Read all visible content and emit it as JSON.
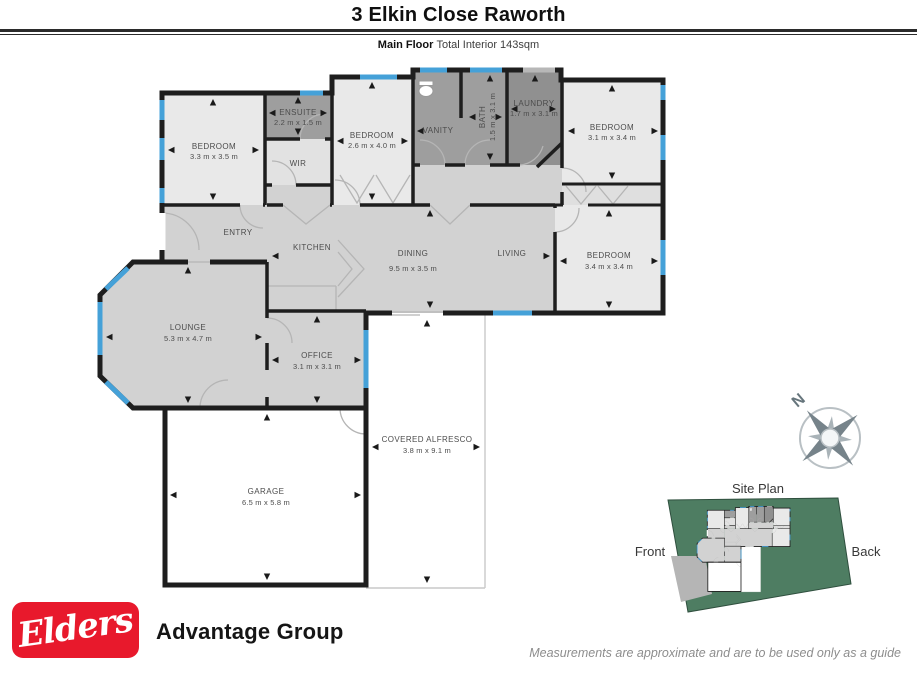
{
  "header": {
    "title": "3 Elkin Close Raworth",
    "floor_label": "Main Floor",
    "floor_info": "Total Interior  143sqm"
  },
  "floorplan": {
    "rooms": {
      "bedroom1": {
        "name": "BEDROOM",
        "dims": "3.3 m x 3.5 m"
      },
      "ensuite": {
        "name": "ENSUITE",
        "dims": "2.2 m x 1.5 m"
      },
      "wir": {
        "name": "WIR"
      },
      "bedroom2": {
        "name": "BEDROOM",
        "dims": "2.6 m x 4.0 m"
      },
      "vanity": {
        "name": "VANITY"
      },
      "bath": {
        "name": "BATH",
        "dims": "1.5 m x 3.1 m"
      },
      "laundry": {
        "name": "LAUNDRY",
        "dims": "1.7 m x 3.1 m"
      },
      "bedroom3": {
        "name": "BEDROOM",
        "dims": "3.1 m x 3.4 m"
      },
      "entry": {
        "name": "ENTRY"
      },
      "kitchen": {
        "name": "KITCHEN"
      },
      "dining": {
        "name": "DINING",
        "dims": "9.5 m x 3.5 m"
      },
      "living": {
        "name": "LIVING"
      },
      "bedroom4": {
        "name": "BEDROOM",
        "dims": "3.4 m x 3.4 m"
      },
      "lounge": {
        "name": "LOUNGE",
        "dims": "5.3 m x 4.7 m"
      },
      "office": {
        "name": "OFFICE",
        "dims": "3.1 m x 3.1 m"
      },
      "alfresco": {
        "name": "COVERED ALFRESCO",
        "dims": "3.8 m x 9.1 m"
      },
      "garage": {
        "name": "GARAGE",
        "dims": "6.5 m x 5.8 m"
      }
    },
    "compass_label": "N"
  },
  "siteplan": {
    "title": "Site Plan",
    "front_label": "Front",
    "back_label": "Back"
  },
  "footer": {
    "brand": "Elders",
    "brand_suffix": "Advantage Group",
    "disclaimer": "Measurements are approximate and are to be used only as a guide"
  },
  "colors": {
    "window_blue": "#45a1d8",
    "wall": "#1e1e1e",
    "room_light": "#e9e9e9",
    "room_medium": "#d2d2d2",
    "room_dark": "#9e9e9e",
    "site_green": "#4e7d62",
    "elders_red": "#e8192c"
  }
}
